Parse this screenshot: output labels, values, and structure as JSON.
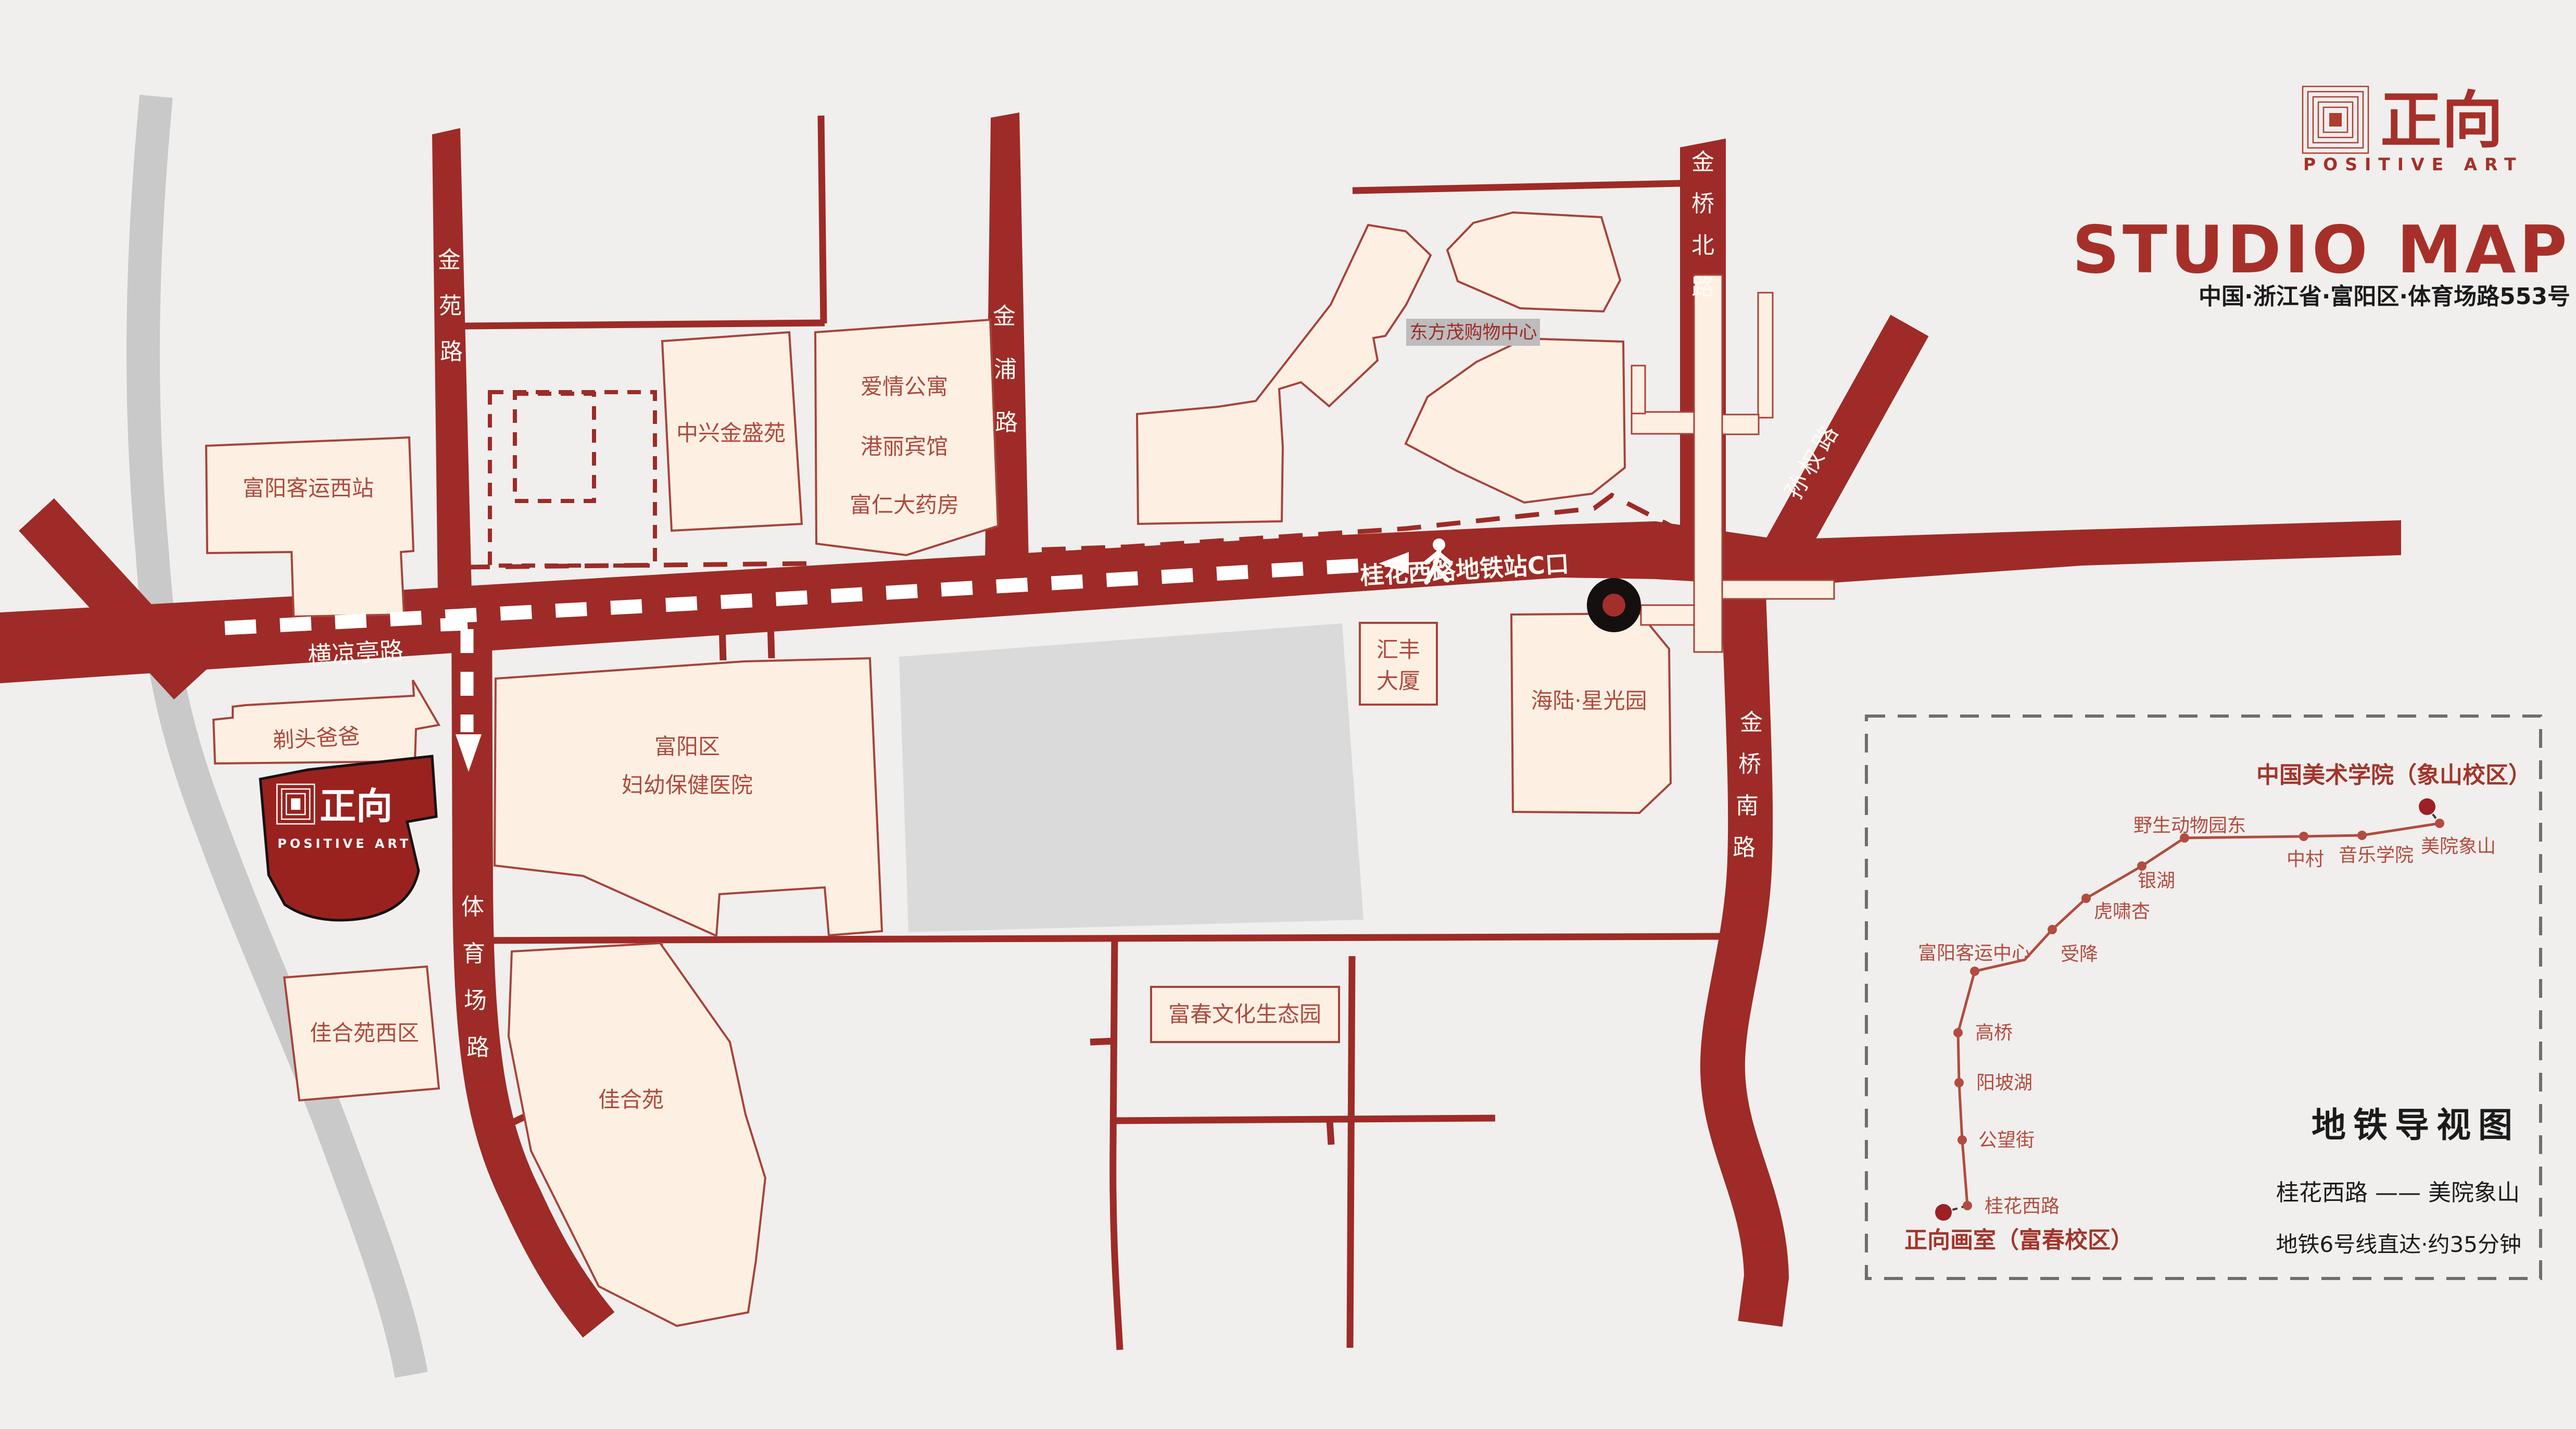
{
  "brand": {
    "name_cn": "正向",
    "name_en": "POSITIVE ART",
    "title": "STUDIO MAP",
    "address": "中国·浙江省·富阳区·体育场路553号"
  },
  "map": {
    "roads": {
      "hengliangting": "横凉亭路",
      "guihua_route_label": "桂花西路地铁站C口",
      "sunquan": "孙权路",
      "jinyuan": {
        "chars": [
          "金",
          "苑",
          "路"
        ]
      },
      "jinpu": {
        "chars": [
          "金",
          "浦",
          "路"
        ]
      },
      "jinqiao_north": {
        "chars": [
          "金",
          "桥",
          "北",
          "路"
        ]
      },
      "jinqiao_south": {
        "chars": [
          "金",
          "桥",
          "南",
          "路"
        ]
      },
      "tiyuchang": {
        "chars": [
          "体",
          "育",
          "场",
          "路"
        ]
      }
    },
    "buildings": {
      "fuyang_west_station": "富阳客运西站",
      "zhongxing": "中兴金盛苑",
      "apartment": [
        "爱情公寓",
        "港丽宾馆",
        "富仁大药房"
      ],
      "dongfangmao": "东方茂购物中心",
      "huifeng_l1": "汇丰",
      "huifeng_l2": "大厦",
      "hailu": "海陆·星光园",
      "hospital_l1": "富阳区",
      "hospital_l2": "妇幼保健医院",
      "titou": "剃头爸爸",
      "jiaheyuan_west": "佳合苑西区",
      "jiaheyuan": "佳合苑",
      "fuchun_park": "富春文化生态园"
    },
    "studio": {
      "logo_cn": "正向",
      "logo_en": "POSITIVE ART"
    }
  },
  "inset": {
    "title": "地铁导视图",
    "route": "桂花西路 —— 美院象山",
    "note": "地铁6号线直达·约35分钟",
    "start_label": "正向画室（富春校区）",
    "end_label": "中国美术学院（象山校区）",
    "stations": [
      {
        "name": "桂花西路"
      },
      {
        "name": "公望街"
      },
      {
        "name": "阳坡湖"
      },
      {
        "name": "高桥"
      },
      {
        "name": "富阳客运中心"
      },
      {
        "name": "受降"
      },
      {
        "name": "虎啸杏"
      },
      {
        "name": "银湖"
      },
      {
        "name": "野生动物园东"
      },
      {
        "name": "中村"
      },
      {
        "name": "音乐学院"
      },
      {
        "name": "美院象山"
      }
    ]
  }
}
